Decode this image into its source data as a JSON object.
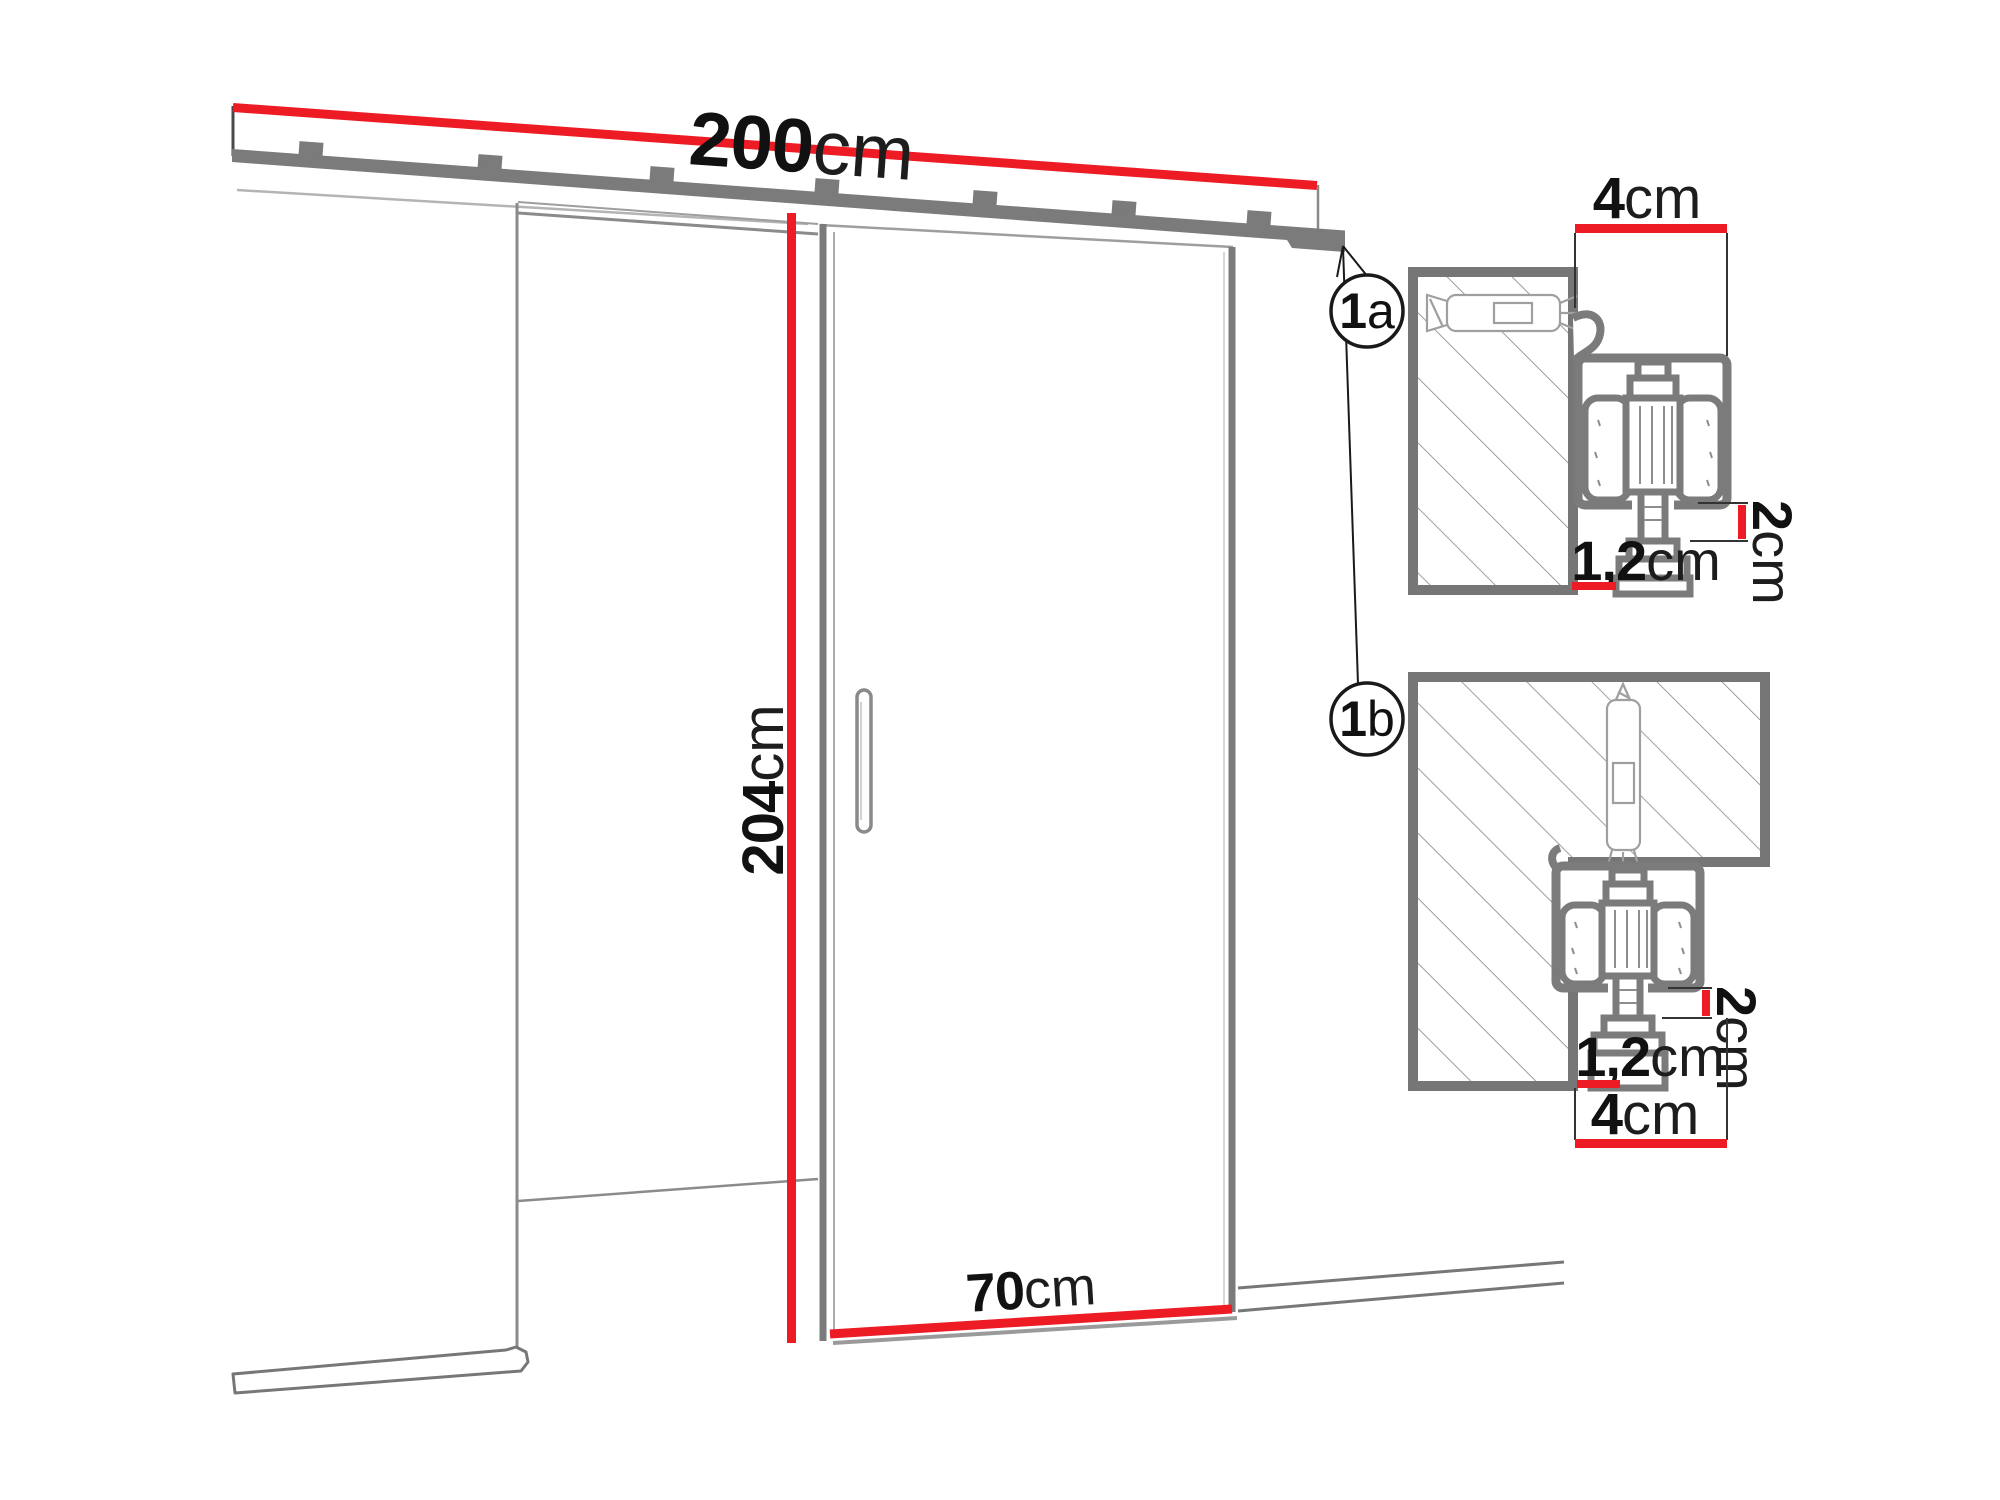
{
  "colors": {
    "dimension_red": "#ED1C24",
    "structure_gray": "#7b7b7b",
    "thin_line_gray": "#9a9a9a",
    "text_black": "#111111"
  },
  "main_drawing": {
    "rail_width": {
      "value": "200",
      "unit": "cm"
    },
    "door_height": {
      "value": "204",
      "unit": "cm"
    },
    "door_width": {
      "value": "70",
      "unit": "cm"
    }
  },
  "details": {
    "wall_mount": {
      "balloon": {
        "number": "1",
        "letter": "a"
      },
      "track_width": {
        "value": "4",
        "unit": "cm"
      },
      "drop_gap": {
        "value": "2",
        "unit": "cm"
      },
      "wall_clearance": {
        "value": "1,2",
        "unit": "cm"
      }
    },
    "ceiling_mount": {
      "balloon": {
        "number": "1",
        "letter": "b"
      },
      "track_width": {
        "value": "4",
        "unit": "cm"
      },
      "drop_gap": {
        "value": "2",
        "unit": "cm"
      },
      "wall_clearance": {
        "value": "1,2",
        "unit": "cm"
      }
    }
  }
}
